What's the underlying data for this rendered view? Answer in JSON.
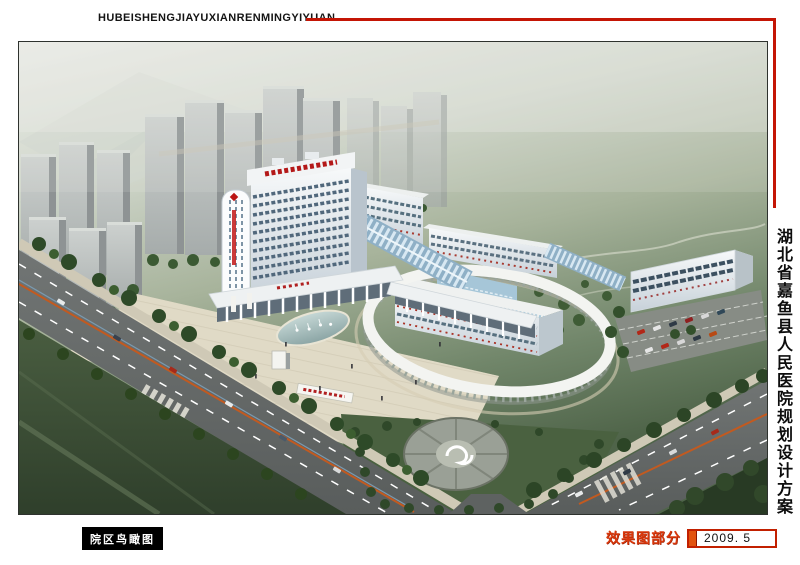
{
  "header": {
    "romanized_title": "HUBEISHENGJIAYUXIANRENMINGYIYUAN"
  },
  "side_title": {
    "text": "湖北省嘉鱼县人民医院规划设计方案"
  },
  "caption": {
    "view_label": "院区鸟瞰图"
  },
  "footer": {
    "section_label": "效果图部分",
    "date": "2009. 5"
  },
  "colors": {
    "accent_red": "#c41505",
    "caption_bg": "#000000",
    "caption_text": "#ffffff",
    "section_label_red": "#d9380c",
    "date_box_border": "#c22000",
    "date_bar_fill": "#e2520e",
    "hospital_sign_red": "#b41818",
    "glass_vault_blue": "#8fb0c6"
  }
}
